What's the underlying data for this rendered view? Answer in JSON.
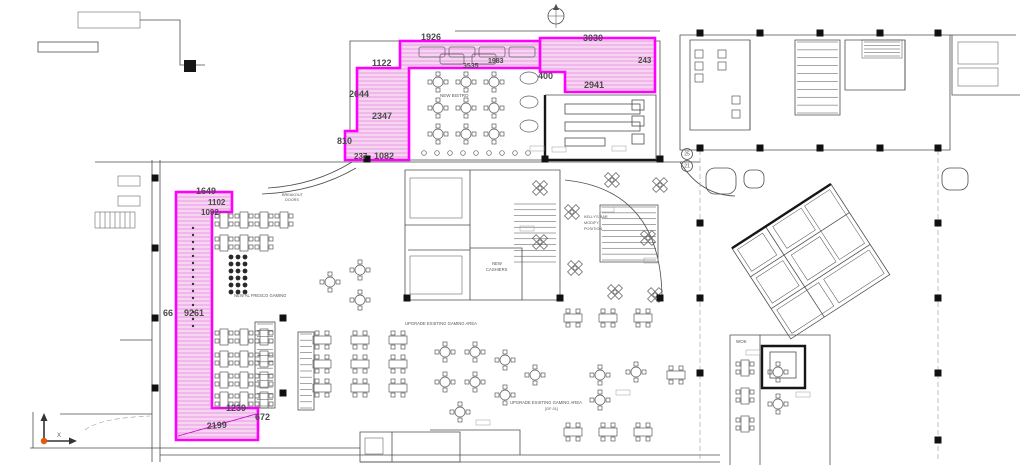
{
  "drawing": {
    "kind": "casino floor plan - renovation markup",
    "colors": {
      "highlight": "#ff00ff",
      "highlight_leader": "#cc00cc",
      "hatch_fill": "#f9ddf6",
      "hatch_line": "#e693df",
      "wall": "#4d4d4d",
      "wall_dark": "#161616",
      "dim_text": "#4a4a4a",
      "label_text": "#555555",
      "ucs_origin": "#e05a10",
      "background": "#ffffff"
    },
    "dimensions": [
      {
        "value": "1926",
        "x": 421,
        "y": 40,
        "size": 9
      },
      {
        "value": "1122",
        "x": 372,
        "y": 66,
        "size": 9
      },
      {
        "value": "2644",
        "x": 349,
        "y": 97,
        "size": 9
      },
      {
        "value": "2347",
        "x": 372,
        "y": 119,
        "size": 9
      },
      {
        "value": "810",
        "x": 337,
        "y": 144,
        "size": 9
      },
      {
        "value": "237",
        "x": 354,
        "y": 159,
        "size": 8
      },
      {
        "value": "1082",
        "x": 374,
        "y": 159,
        "size": 9
      },
      {
        "value": "3535",
        "x": 463,
        "y": 68,
        "size": 7
      },
      {
        "value": "1983",
        "x": 488,
        "y": 63,
        "size": 7
      },
      {
        "value": "3030",
        "x": 583,
        "y": 41,
        "size": 9
      },
      {
        "value": "400",
        "x": 538,
        "y": 79,
        "size": 9
      },
      {
        "value": "2941",
        "x": 584,
        "y": 88,
        "size": 9
      },
      {
        "value": "243",
        "x": 638,
        "y": 63,
        "size": 8
      },
      {
        "value": "1649",
        "x": 196,
        "y": 194,
        "size": 9
      },
      {
        "value": "1102",
        "x": 208,
        "y": 205,
        "size": 8
      },
      {
        "value": "1092",
        "x": 201,
        "y": 215,
        "size": 8
      },
      {
        "value": "66",
        "x": 163,
        "y": 316,
        "size": 9
      },
      {
        "value": "9261",
        "x": 184,
        "y": 316,
        "size": 9
      },
      {
        "value": "1239",
        "x": 226,
        "y": 411,
        "size": 9
      },
      {
        "value": "2199",
        "x": 207,
        "y": 429,
        "size": 9,
        "rotate": -4
      },
      {
        "value": "672",
        "x": 255,
        "y": 420,
        "size": 9
      }
    ],
    "labels": [
      {
        "text": "NEW BISTRO",
        "x": 440,
        "y": 97,
        "size": 4.5
      },
      {
        "text": "BREAKOUT",
        "x": 282,
        "y": 196,
        "size": 3.8
      },
      {
        "text": "DOORS",
        "x": 285,
        "y": 201,
        "size": 3.8
      },
      {
        "text": "NEW AL FRESCO GAMING",
        "x": 234,
        "y": 297,
        "size": 4.2
      },
      {
        "text": "NEW",
        "x": 492,
        "y": 265,
        "size": 4.2
      },
      {
        "text": "CASHIERS",
        "x": 486,
        "y": 271,
        "size": 4.2
      },
      {
        "text": "KELLY'S BAR",
        "x": 584,
        "y": 218,
        "size": 3.8
      },
      {
        "text": "MODIFY",
        "x": 584,
        "y": 224,
        "size": 3.8
      },
      {
        "text": "POSITION",
        "x": 584,
        "y": 230,
        "size": 3.8
      },
      {
        "text": "UPGRADE EXISTING GAMING AREA",
        "x": 405,
        "y": 325,
        "size": 4.2
      },
      {
        "text": "UPGRADE EXISTING GAMING AREA",
        "x": 510,
        "y": 404,
        "size": 4.2
      },
      {
        "text": "[GF-01]",
        "x": 545,
        "y": 410,
        "size": 3.8
      },
      {
        "text": "WOK",
        "x": 736,
        "y": 343,
        "size": 4.5
      },
      {
        "text": "X",
        "x": 57,
        "y": 437,
        "size": 6
      }
    ],
    "grid_bubbles": [
      {
        "text": "25",
        "x": 687,
        "y": 154
      },
      {
        "text": "21",
        "x": 687,
        "y": 166
      }
    ]
  }
}
